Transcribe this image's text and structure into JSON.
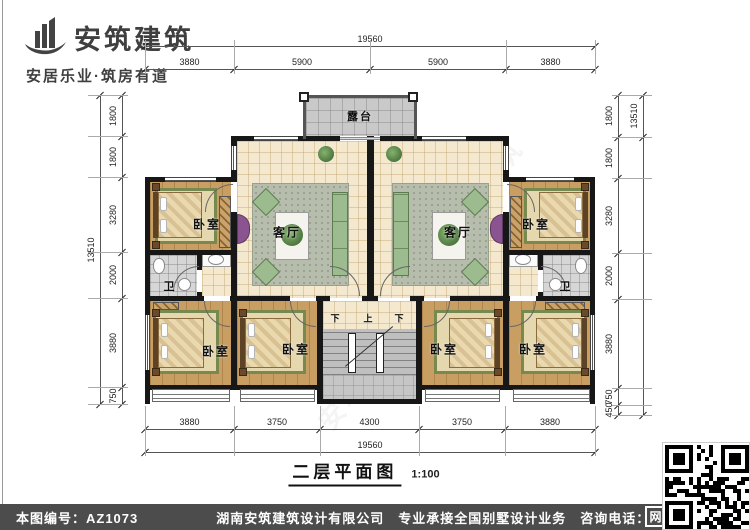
{
  "logo": {
    "name": "安筑建筑",
    "tagline": "安居乐业·筑房有道"
  },
  "watermark": "安筑建筑",
  "plan": {
    "title": "二层平面图",
    "scale": "1:100",
    "rooms": {
      "terrace": "露台",
      "living": "客厅",
      "bedroom": "卧室",
      "bath": "卫",
      "stair_up": "上",
      "stair_down": "下"
    },
    "dims": {
      "top_overall": "19560",
      "top_segments": [
        "3880",
        "5900",
        "5900",
        "3880"
      ],
      "bottom_overall": "19560",
      "bottom_segments": [
        "3880",
        "3750",
        "4300",
        "3750",
        "3880"
      ],
      "left_overall": "13510",
      "left_segments": [
        "1800",
        "1800",
        "3280",
        "2000",
        "3880",
        "750"
      ],
      "right_overall": "13510",
      "right_segments": [
        "1800",
        "1800",
        "3280",
        "2000",
        "3880",
        "750",
        "450"
      ]
    }
  },
  "footer": {
    "drawing_no": "本图编号：AZ1073",
    "company": "湖南安筑建筑设计有限公司",
    "service": "专业承接全国别墅设计业务",
    "phone": "咨询电话：400-8070-511",
    "net_badge": "网"
  },
  "colors": {
    "wall": "#171717",
    "floor_tile": "#f4e9cf",
    "wood_floor": "#c89e62",
    "gray_tile": "#c9c9c9",
    "rug_green": "#77894f",
    "sofa_green": "#9cbb8e",
    "console_purple": "#8a5490",
    "footer_bg": "#4c4c4c"
  }
}
